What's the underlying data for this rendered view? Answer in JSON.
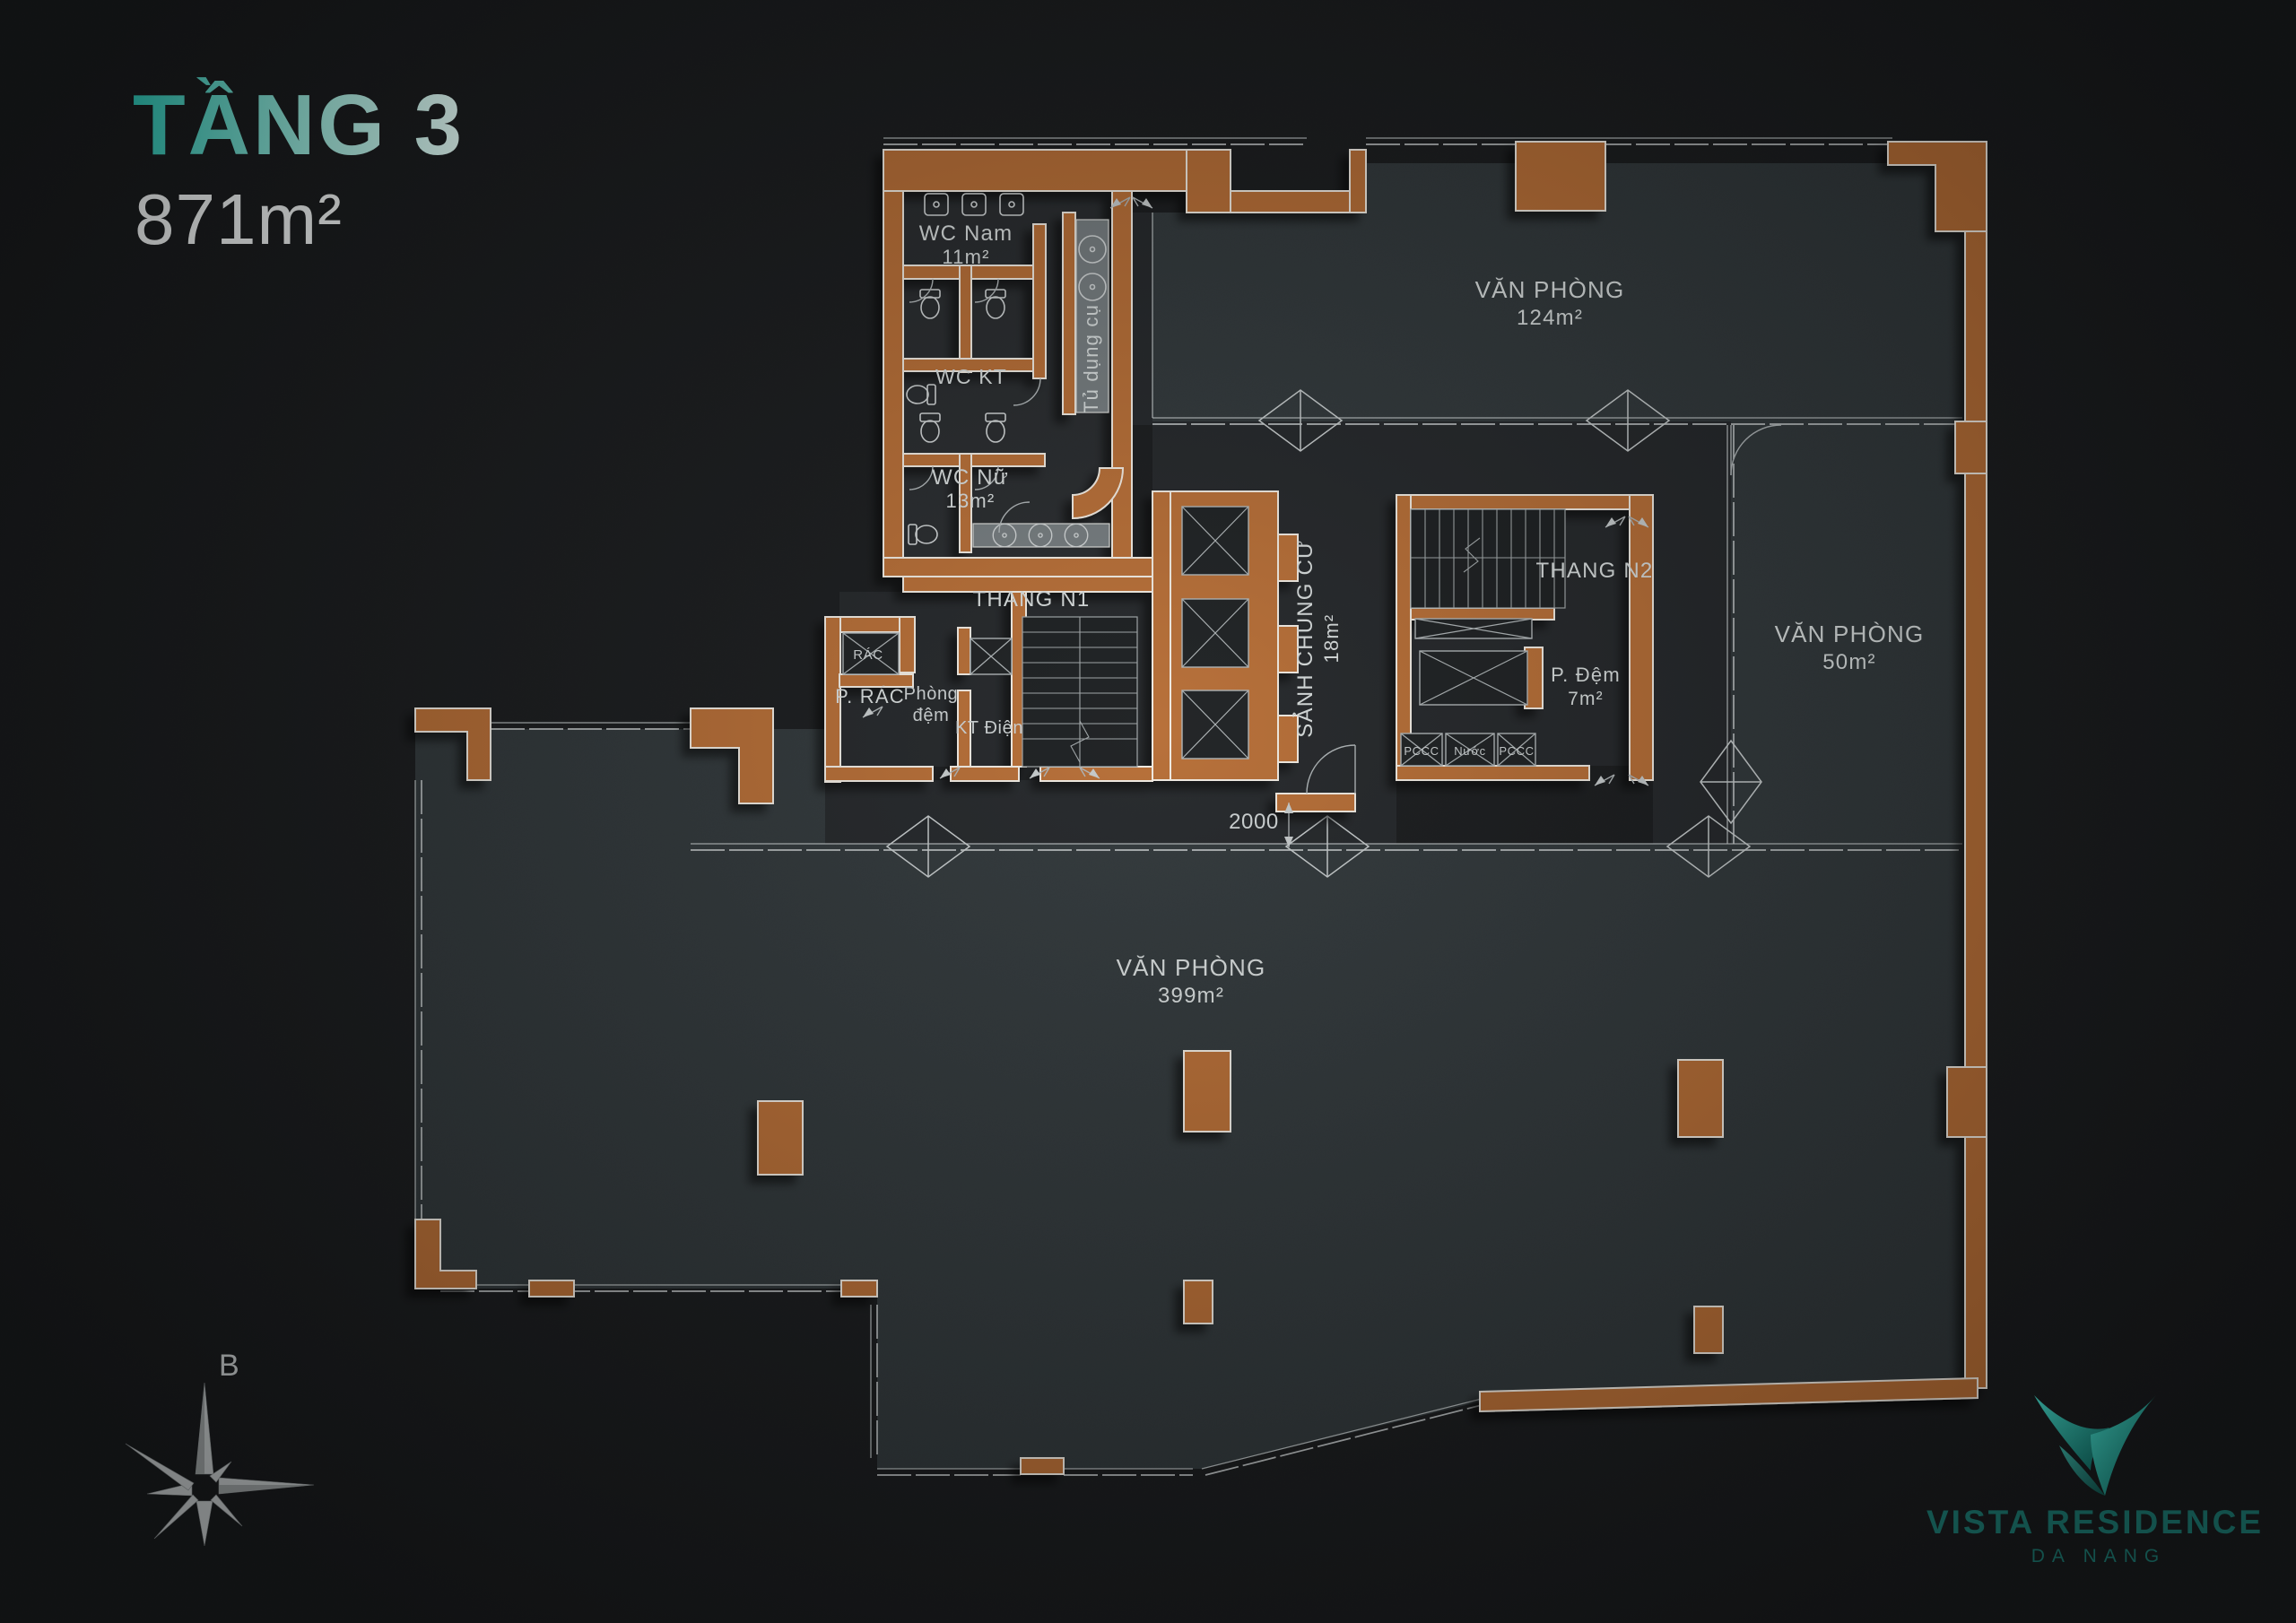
{
  "header": {
    "floor_title": "TẦNG 3",
    "floor_area": "871m²"
  },
  "compass": {
    "north_label": "B"
  },
  "brand": {
    "name": "VISTA RESIDENCE",
    "location": "DA NANG"
  },
  "plan": {
    "dimension_2000": "2000",
    "rooms": {
      "wc_nam": {
        "name": "WC Nam",
        "area": "11m²"
      },
      "wc_kt": {
        "name": "WC KT"
      },
      "wc_nu": {
        "name": "WC Nữ",
        "area": "13m²"
      },
      "tu_dung_cu": {
        "name": "Tủ dụng cụ"
      },
      "thang_n1": {
        "name": "THANG N1"
      },
      "thang_n2": {
        "name": "THANG N2"
      },
      "rac": {
        "name": "RÁC"
      },
      "p_rac": {
        "name": "P. RÁC"
      },
      "phong_dem": {
        "line1": "Phòng",
        "line2": "đệm"
      },
      "kt_dien": {
        "name": "KT Điện"
      },
      "sanh_chung_cu": {
        "name": "SẢNH CHUNG CƯ",
        "area": "18m²"
      },
      "p_dem": {
        "name": "P. Đệm",
        "area": "7m²"
      },
      "pccc_left": {
        "name": "PCCC"
      },
      "nuoc": {
        "name": "Nước"
      },
      "pccc_right": {
        "name": "PCCC"
      },
      "van_phong_124": {
        "name": "VĂN PHÒNG",
        "area": "124m²"
      },
      "van_phong_50": {
        "name": "VĂN PHÒNG",
        "area": "50m²"
      },
      "van_phong_399": {
        "name": "VĂN PHÒNG",
        "area": "399m²"
      }
    }
  },
  "colors": {
    "wall_orange": "#b66d36",
    "accent_teal": "#2ec4b4",
    "logo_teal": "#1d7b73"
  }
}
